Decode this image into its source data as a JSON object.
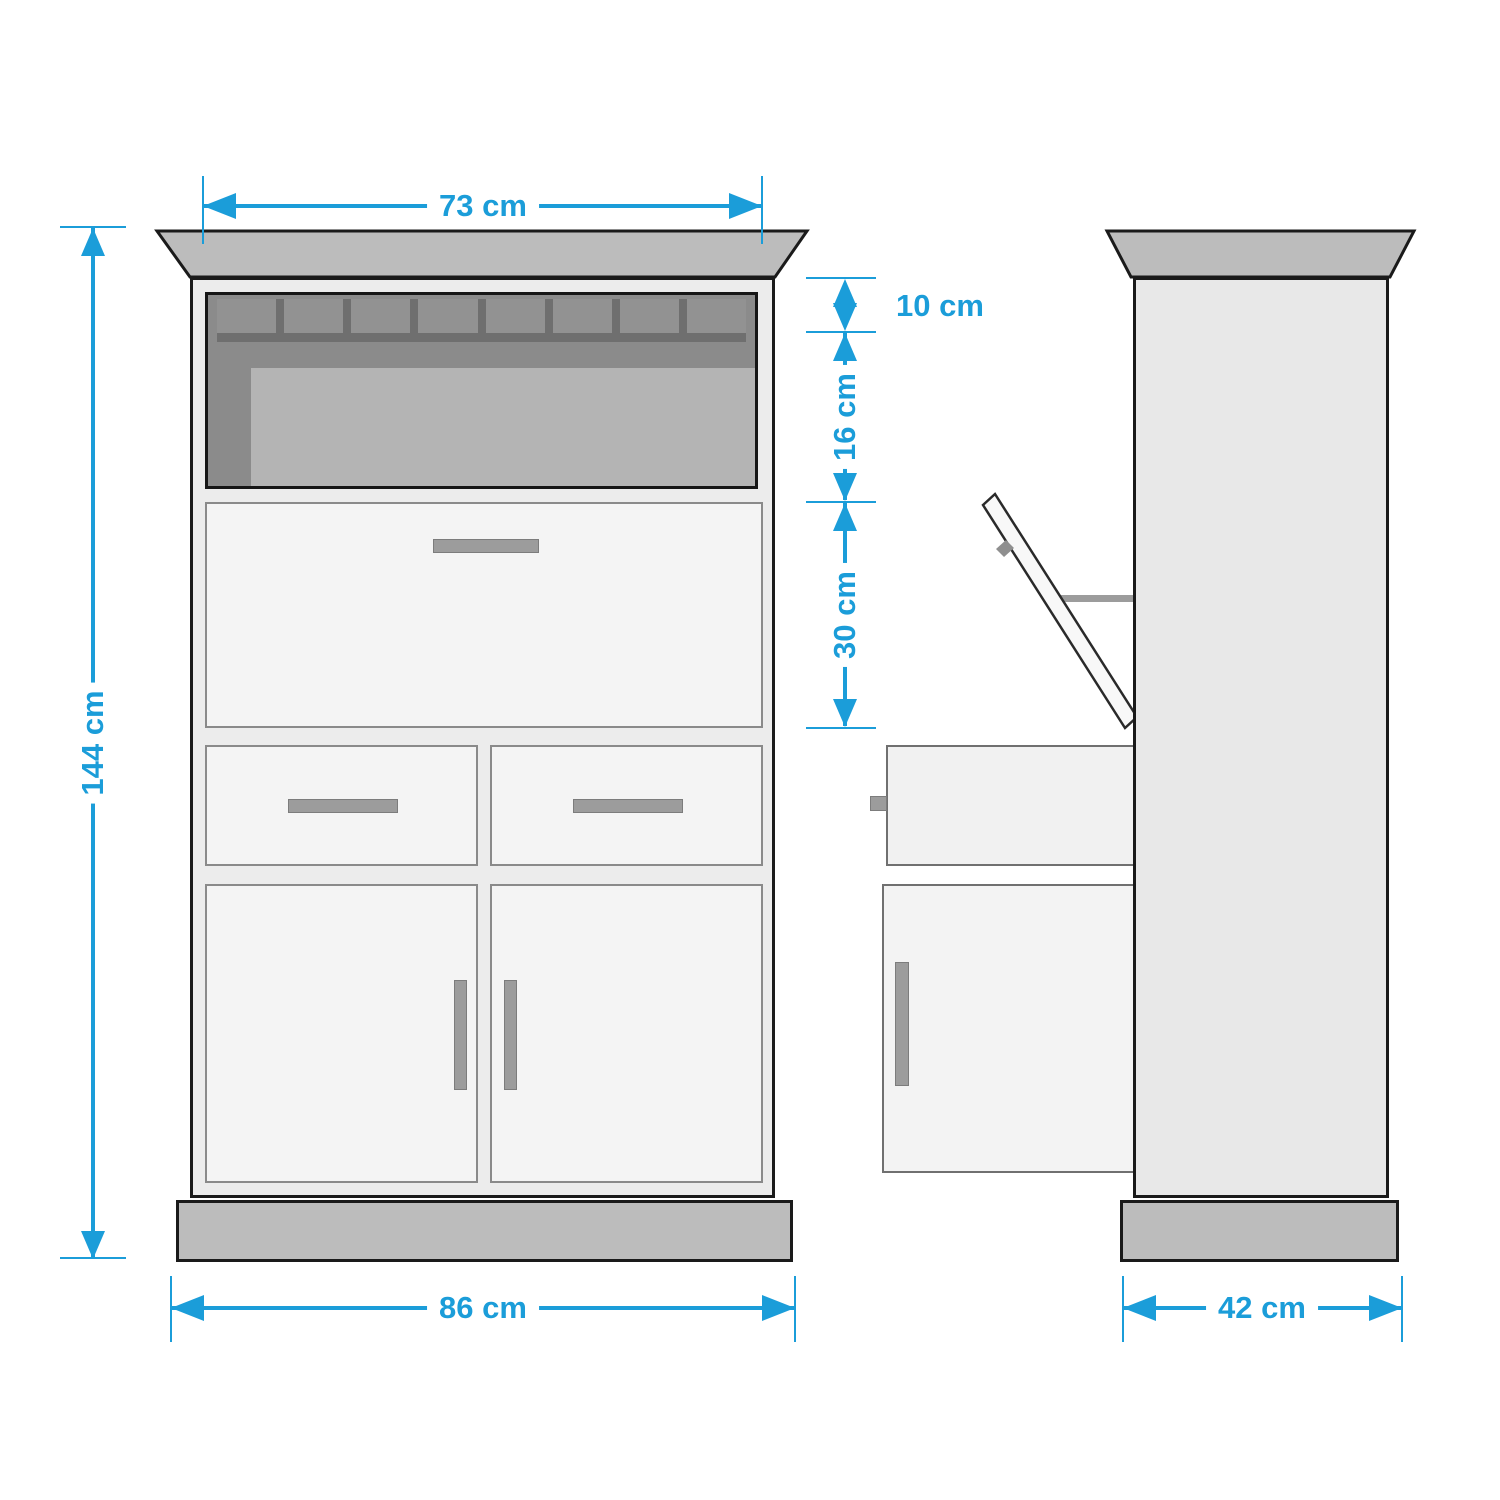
{
  "diagram": {
    "dims": {
      "width_top": "73 cm",
      "shelf_upper": "10 cm",
      "shelf_lower": "16 cm",
      "flap_height": "30 cm",
      "height_total": "144 cm",
      "width_base": "86 cm",
      "depth": "42 cm"
    },
    "colors": {
      "dimension_blue": "#1b9dd9",
      "outline": "#1a1a1a",
      "carcass_gray": "#ececec",
      "front_panel_gray": "#f4f4f4",
      "trim_gray": "#bcbcbc",
      "niche_gray": "#8b8b8b",
      "back_panel_gray": "#b4b4b4",
      "handle_gray": "#9c9c9c"
    }
  }
}
